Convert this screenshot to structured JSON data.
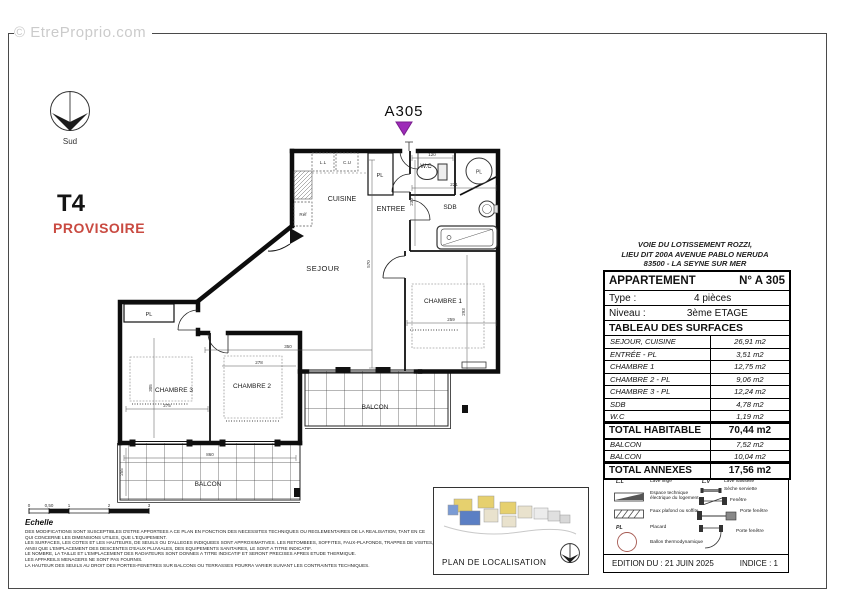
{
  "watermark": "© EtreProprio.com",
  "compass": {
    "label": "Sud"
  },
  "plan_header": {
    "type_label": "T4",
    "status_label": "PROVISOIRE",
    "apartment_marker": "A305"
  },
  "colors": {
    "status_red": "#c94a41",
    "marker_purple": "#9d2bb8",
    "watermark_gray": "#cbcbcb"
  },
  "floorplan": {
    "rooms": {
      "cuisine": "CUISINE",
      "entree": "ENTREE",
      "sejour": "SEJOUR",
      "wc": "W.C",
      "sdb": "SDB",
      "chambre1": "CHAMBRE 1",
      "chambre2": "CHAMBRE 2",
      "chambre3": "CHAMBRE 3",
      "balcon1": "BALCON",
      "balcon2": "BALCON",
      "pl_entree": "PL",
      "pl_chambre3": "PL",
      "pl_ballon": "PL"
    },
    "fixtures": {
      "cu": "C.U",
      "ll": "L.L",
      "ref": "Réf"
    },
    "dimensions": {
      "wc_w": "120",
      "sdb_w": "221",
      "entree_h": "230",
      "sejour_h": "570",
      "sejour_w": "350",
      "ch1_w": "259",
      "ch1_h": "293",
      "ch2_w": "278",
      "ch3_w": "275",
      "ch3_h": "305",
      "balcon2_w": "860",
      "balcon2_h": "255"
    }
  },
  "info_panel": {
    "address_lines": [
      "VOIE DU LOTISSEMENT ROZZI,",
      "LIEU DIT 200A AVENUE PABLO NERUDA",
      "83500 - LA SEYNE SUR MER"
    ],
    "apartment_row": {
      "label": "APPARTEMENT",
      "value": "N° A 305"
    },
    "type_row": {
      "label": "Type :",
      "value": "4 pièces"
    },
    "level_row": {
      "label": "Niveau :",
      "value": "3ème ETAGE"
    },
    "surfaces_title": "TABLEAU DES SURFACES",
    "surface_rows": [
      {
        "label": "SEJOUR, CUISINE",
        "value": "26,91 m2"
      },
      {
        "label": "ENTRÉE - PL",
        "value": "3,51 m2"
      },
      {
        "label": "CHAMBRE 1",
        "value": "12,75 m2"
      },
      {
        "label": "CHAMBRE 2 - PL",
        "value": "9,06 m2"
      },
      {
        "label": "CHAMBRE 3 - PL",
        "value": "12,24 m2"
      },
      {
        "label": "SDB",
        "value": "4,78 m2"
      },
      {
        "label": "W.C",
        "value": "1,19 m2"
      }
    ],
    "total_habitable": {
      "label": "TOTAL HABITABLE",
      "value": "70,44 m2"
    },
    "annex_rows": [
      {
        "label": "BALCON",
        "value": "7,52 m2"
      },
      {
        "label": "BALCON",
        "value": "10,04 m2"
      }
    ],
    "total_annexes": {
      "label": "TOTAL ANNEXES",
      "value": "17,56 m2"
    },
    "legend": {
      "left": [
        {
          "abbr": "Réf.",
          "label": "Réfrigérateur"
        },
        {
          "abbr": "L.L",
          "label": "Lave linge"
        },
        {
          "icon": "espace-technique",
          "label": "Espace technique électrique du logement"
        },
        {
          "icon": "faux-plafond",
          "label": "Faux plafond ou soffite"
        },
        {
          "abbr": "PL",
          "label": "Placard"
        },
        {
          "icon": "ballon",
          "label": "Ballon thermodynamique"
        }
      ],
      "right": [
        {
          "abbr": "C.U",
          "label": "Cuisson / Four"
        },
        {
          "abbr": "L.V",
          "label": "Lave vaisselle"
        },
        {
          "icon": "seche-serviette",
          "label": "Sèche serviette"
        },
        {
          "icon": "fenetre",
          "label": "Fenêtre"
        },
        {
          "icon": "porte-fenetre-coulissante",
          "label": "Porte fenêtre"
        },
        {
          "icon": "porte-fenetre-battante",
          "label": "Porte fenêtre"
        }
      ]
    },
    "edition_row": {
      "edition": "EDITION DU : 21 JUIN 2025",
      "indice": "INDICE : 1"
    }
  },
  "localisation": {
    "label": "PLAN DE LOCALISATION"
  },
  "scale": {
    "label": "Echelle",
    "ticks": [
      "0",
      "0,50",
      "1",
      "2",
      "3"
    ]
  },
  "disclaimer": {
    "lines": [
      "DES MODIFICATIONS SONT SUSCEPTIBLES D'ETRE APPORTEES A CE PLAN EN FONCTION DES NECESSITES TECHNIQUES OU REGLEMENTAIRES DE LA REALISATION, TANT EN CE",
      "QUI CONCERNE LES DIMENSIONS UTILES, QUE L'EQUIPEMENT.",
      "LES SURFACES, LES COTES ET LES HAUTEURS, DE SEUILS OU D'ALLEGES INDIQUEES SONT APPROXIMATIVES. LES RETOMBEES, SOFFITES, FAUX-PLAFONDS, TRAPPES DE VISITES,",
      "AINSI QUE L'EMPLACEMENT DES DESCENTES D'EAUX PLUVIALES, DES EQUIPEMENTS SANITAIRES, LE SONT A TITRE INDICATIF.",
      "LE NOMBRE, LA TAILLE ET L'EMPLACEMENT DES RADIATEURS SONT DONNES A TITRE INDICATIF ET SERONT PRECISES APRES ETUDE THERMIQUE.",
      "LES APPAREILS MENAGERS NE SONT PAS FOURNIS.",
      "LA HAUTEUR DES SEUILS AU DROIT DES PORTES-FENETRES SUR BALCONS OU TERRASSES POURRA VARIER SUIVANT LES CONTRAINTES TECHNIQUES."
    ]
  }
}
